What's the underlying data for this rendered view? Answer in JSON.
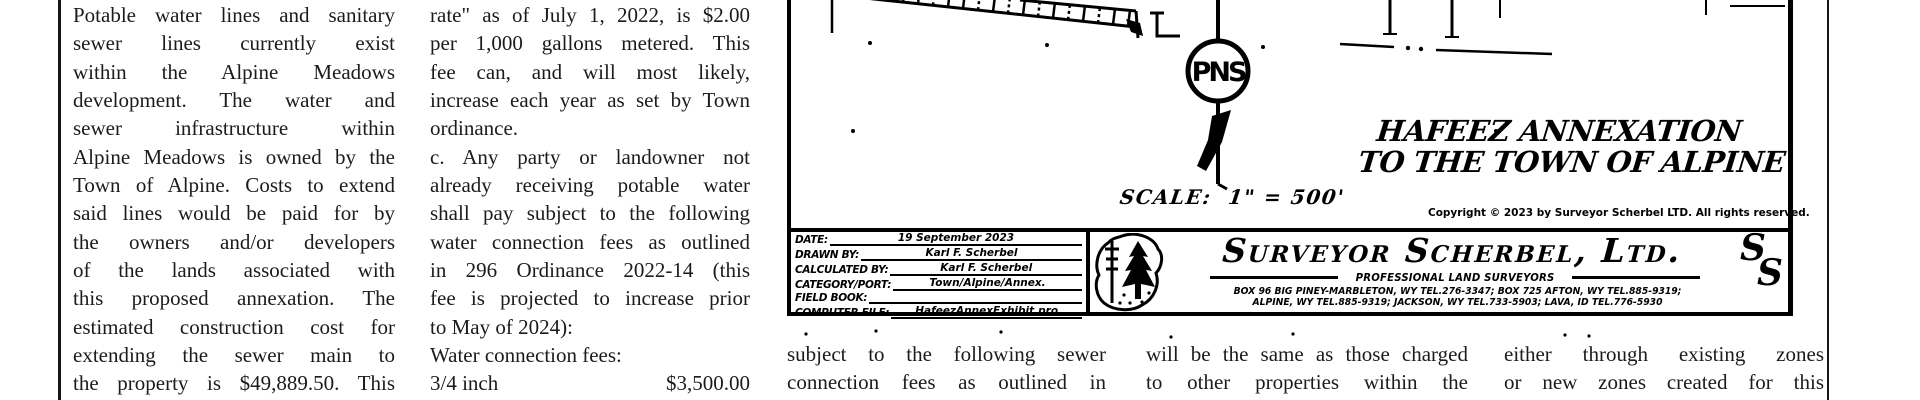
{
  "article": {
    "col1_lines": [
      "Potable water lines and sanitary",
      "sewer lines currently exist",
      "within the Alpine Meadows",
      "development. The water and",
      "sewer infrastructure within",
      "Alpine Meadows is owned by the",
      "Town of Alpine. Costs to extend",
      "said lines would be paid for by",
      "the owners and/or developers",
      "of the lands associated with",
      "this proposed annexation. The",
      "estimated construction cost for",
      "extending the sewer main to",
      "the property is $49,889.50. This"
    ],
    "col2_lines": [
      "rate\" as of July 1, 2022, is $2.00",
      "per 1,000 gallons metered. This",
      "fee can, and will most likely,",
      "increase each year as set by Town",
      "ordinance.",
      "c. Any party or landowner not",
      "already receiving potable water",
      "shall pay subject to the following",
      "water connection fees as outlined",
      "in 296 Ordinance 2022-14 (this",
      "fee is projected to increase prior",
      "to May of 2024):",
      "Water connection fees:"
    ],
    "col2_fee_row": {
      "left": "3/4 inch",
      "right": "$3,500.00"
    },
    "bottom_col1_lines": [
      "subject to the following sewer",
      "connection fees as outlined in"
    ],
    "bottom_col2_lines": [
      "will be the same as those charged",
      "to other properties within the"
    ],
    "bottom_col3_lines": [
      "either through existing zones",
      "or new zones created for this"
    ]
  },
  "map": {
    "title_line1": "HAFEEZ ANNEXATION",
    "title_line2": "TO THE TOWN OF ALPINE",
    "scale_text": "SCALE:  1\" = 500'",
    "copyright": "Copyright © 2023 by Surveyor Scherbel LTD. All rights reserved.",
    "north_monogram_letters": "PNS",
    "title_block": {
      "rows": [
        {
          "label": "DATE:",
          "value": "19 September 2023"
        },
        {
          "label": "DRAWN BY:",
          "value": "Karl F. Scherbel"
        },
        {
          "label": "CALCULATED BY:",
          "value": "Karl F. Scherbel"
        },
        {
          "label": "CATEGORY/PORT:",
          "value": "Town/Alpine/Annex."
        },
        {
          "label": "FIELD BOOK:",
          "value": ""
        },
        {
          "label": "COMPUTER FILE:",
          "value": "HafeezAnnexExhibit.pro"
        }
      ]
    },
    "firm": {
      "name": "Surveyor Scherbel, Ltd.",
      "tagline": "PROFESSIONAL LAND SURVEYORS",
      "address_line1": "BOX 96 BIG PINEY-MARBLETON, WY TEL.276-3347; BOX 725 AFTON, WY TEL.885-9319;",
      "address_line2": "ALPINE, WY TEL.885-9319; JACKSON, WY TEL.733-5903; LAVA, ID TEL.776-5930",
      "monogram_s1": "S",
      "monogram_s2": "S"
    },
    "colors": {
      "ink": "#000000",
      "body_text": "#1b1b1b",
      "paper": "#ffffff"
    }
  }
}
